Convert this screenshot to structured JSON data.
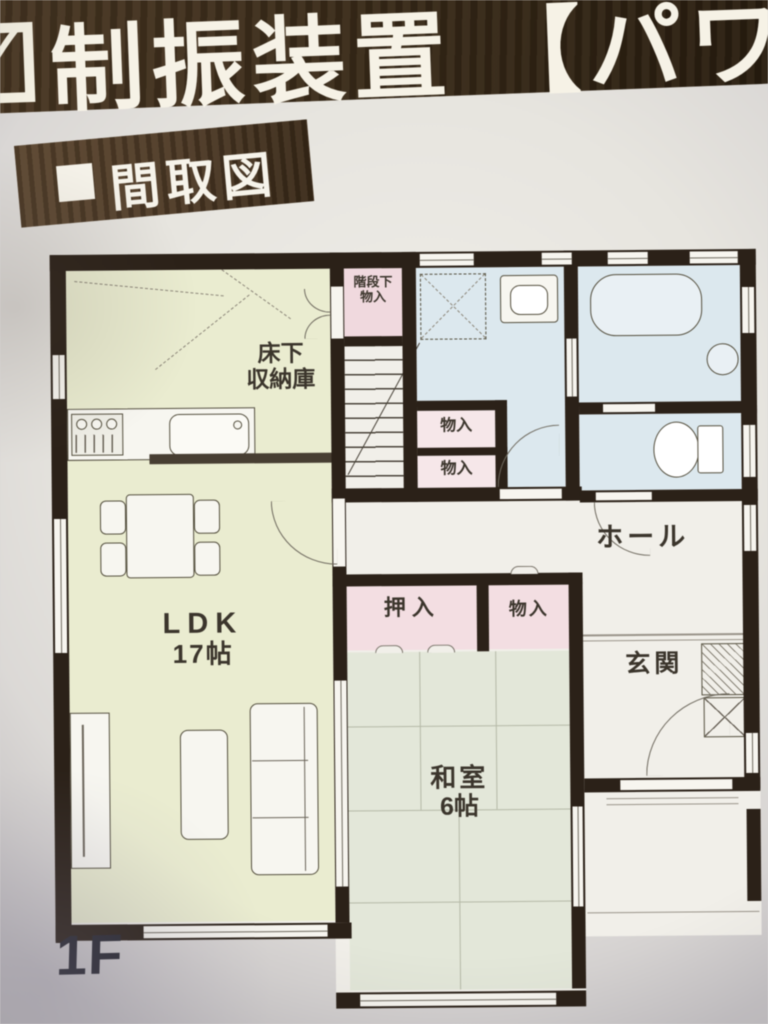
{
  "header": {
    "checkbox_icon": "✓",
    "title": "制振装置 【パワ"
  },
  "banner": {
    "bullet_icon": "■",
    "label": "間取図"
  },
  "plan": {
    "floor_label": "1F",
    "rooms": {
      "ldk": {
        "name": "LDK",
        "size": "17帖"
      },
      "washitsu": {
        "name": "和室",
        "size": "6帖"
      },
      "hall": {
        "name": "ホール"
      },
      "genkan": {
        "name": "玄関"
      },
      "oshiire": {
        "name": "押入"
      },
      "monoire_upper": {
        "name": "物入"
      },
      "monoire_lower": {
        "name": "物入"
      },
      "monoire_hall": {
        "name": "物入"
      },
      "kaidanshita_monoire": {
        "line1": "階段下",
        "line2": "物入"
      },
      "yukashita_shunou": {
        "line1": "床下",
        "line2": "収納庫"
      }
    },
    "fixtures": [
      "kitchen-stove",
      "kitchen-sink",
      "dining-table",
      "dining-chairs",
      "sofa",
      "coffee-table",
      "tv-board",
      "bathtub",
      "shower-stool",
      "washbasin",
      "toilet",
      "stairs",
      "washer-pan",
      "shoe-cabinet"
    ]
  },
  "palette": {
    "wall": "#2b2118",
    "paper": "#f1efe9",
    "ldk_fill": "#eaecd0",
    "tatami_fill": "#e3e7d9",
    "wet_fill": "#dce8ee",
    "closet_fill": "#f3dee2",
    "header_brown": "#3a2b19",
    "banner_brown": "#4e3a26"
  }
}
